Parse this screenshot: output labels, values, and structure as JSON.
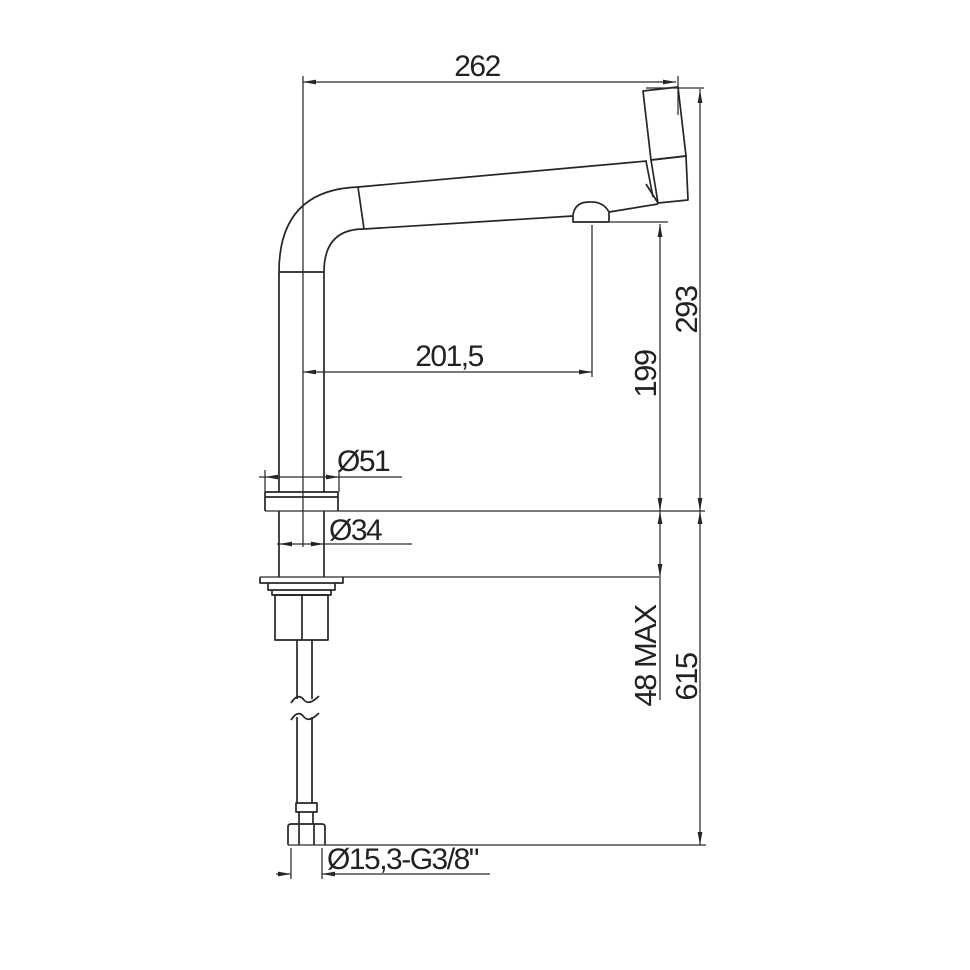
{
  "drawing": {
    "type": "technical-dimension-drawing",
    "subject": "single-lever kitchen mixer tap, side elevation",
    "background": "#ffffff",
    "line_color": "#262626",
    "labels": {
      "top_width": "262",
      "spout_reach": "201,5",
      "outlet_height": "199",
      "height_above_deck": "293",
      "base_diameter": "Ø51",
      "body_diameter": "Ø34",
      "deck_thickness_max": "48 MAX",
      "hose_drop": "615",
      "hose_thread": "Ø15,3-G3/8\""
    }
  }
}
